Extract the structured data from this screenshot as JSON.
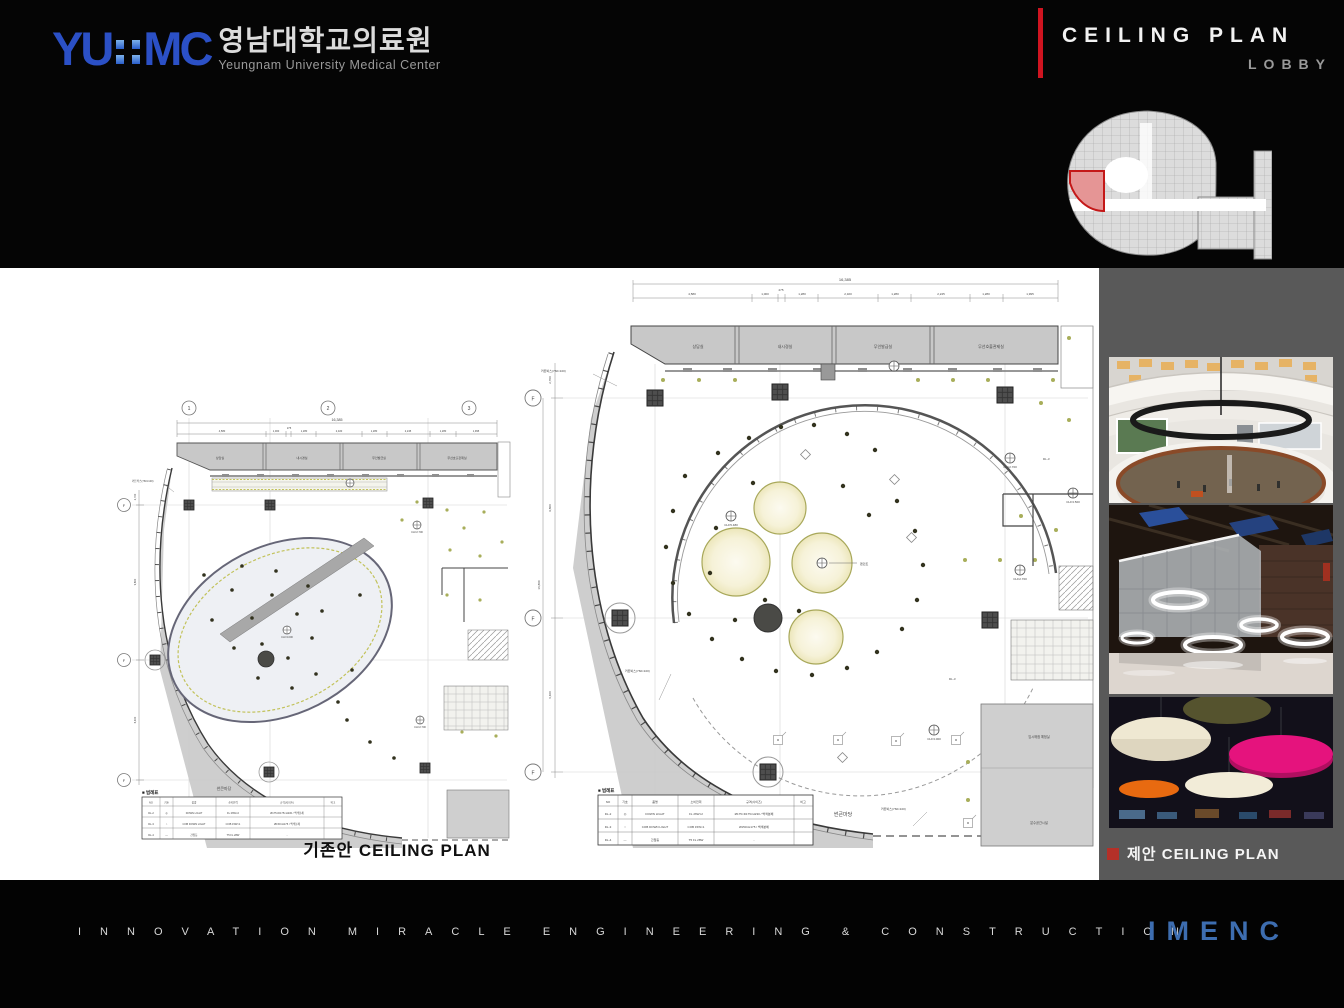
{
  "header": {
    "logo": {
      "yu": "YU",
      "mc": "MC",
      "kr": "영남대학교의료원",
      "en": "Yeungnam University Medical Center"
    },
    "title": "CEILING PLAN",
    "subtitle": "LOBBY"
  },
  "plans": {
    "common": {
      "dim_total": "16,385",
      "dims": [
        "4,580",
        "1,000",
        "275",
        "1,280",
        "2,320",
        "1,280",
        "2,245",
        "1,280",
        "1,995"
      ],
      "grid_cols": [
        "1",
        "2",
        "3"
      ],
      "grid_row": "F",
      "rooms": [
        "상담실",
        "내시경실",
        "무인발급실",
        "무선호출관제실"
      ],
      "area_label": "썬큰마당",
      "leader_label": "커튼박스(760×100)",
      "legend": {
        "title": "■ 범례표",
        "headers": [
          "NO",
          "기호",
          "품명",
          "소비전력",
          "규격(사이즈)",
          "비고"
        ],
        "rows": [
          [
            "DL-2",
            "◎",
            "DOWN LIGHT",
            "FL 26W×2",
            "Ø175×D175×H230 / 백색분체",
            ""
          ],
          [
            "DL-3",
            "○",
            "COB DOWN LIGHT",
            "COB 15W×1",
            "Ø150×H175 / 백색분체",
            ""
          ],
          [
            "DL-4",
            "—",
            "간접등",
            "T5 FL 28W",
            "-",
            ""
          ]
        ]
      }
    },
    "existing": {
      "caption": "기존안 CEILING PLAN",
      "vdims": [
        "2,700",
        "9,800",
        "6,400"
      ],
      "ch_labels": [
        "CH=2.700",
        "CH=3.000",
        "CH=2.700"
      ]
    },
    "proposed": {
      "vdims": [
        "2,700",
        "9,800",
        "16,800",
        "6,400"
      ],
      "ch_labels": [
        "CH=5.480",
        "CH=2.700",
        "CH=3.500",
        "CH=2.700",
        "CH=3.000"
      ],
      "pendant_label": "팬던트",
      "dl_label": "DL-3",
      "rooms_br": [
        "임시매점 예정실",
        "분수공간시설"
      ]
    }
  },
  "proposal_panel": {
    "caption": "제안 CEILING PLAN",
    "photos": [
      {
        "name": "atrium-round-chandelier"
      },
      {
        "name": "ring-pendant-lights"
      },
      {
        "name": "color-disc-ceiling"
      }
    ]
  },
  "footer": {
    "tagline": "INNOVATION MIRACLE ENGINEERING & CONSTRUCTION",
    "brand": "IMENC"
  },
  "colors": {
    "accent_red": "#cf1420",
    "brand_blue": "#2b50c6",
    "imenc_blue": "#3d6db0",
    "panel_gray": "#595959",
    "keymap_highlight": "#c41818"
  }
}
